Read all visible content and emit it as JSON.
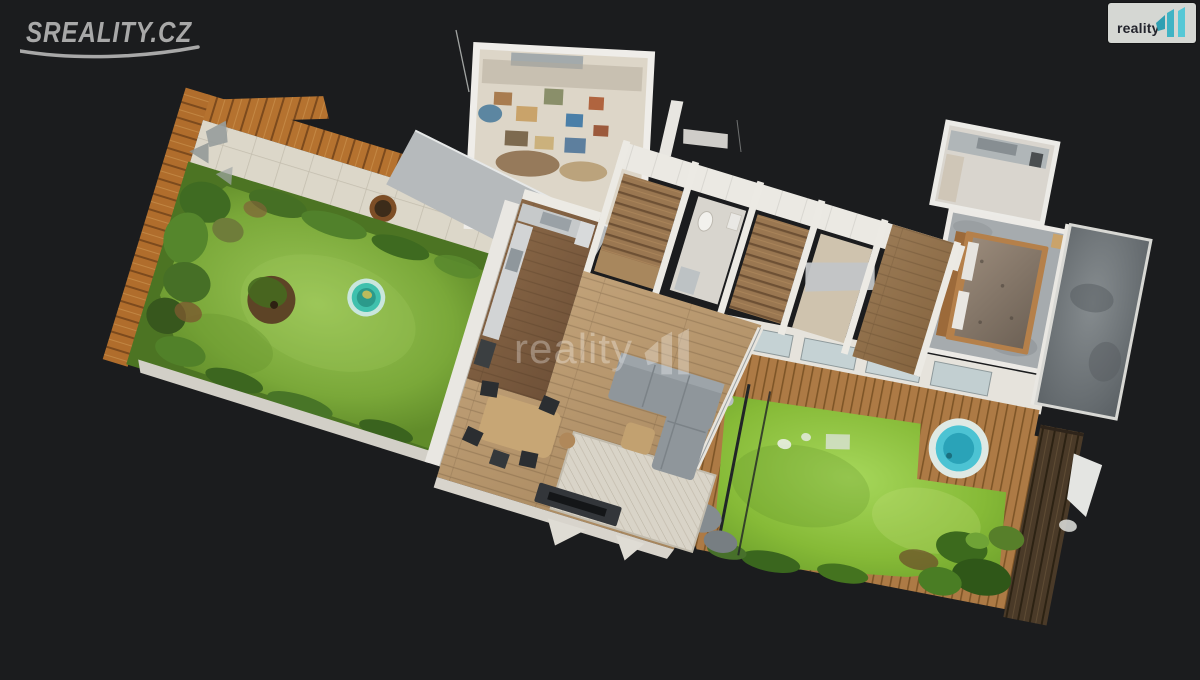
{
  "page": {
    "background": "#1b1c1e"
  },
  "header": {
    "sreality_logo": {
      "text": "SREALITY.CZ",
      "color": "#a8a8a8"
    },
    "reality11_badge": {
      "text": "reality",
      "background": "#d5d7d3",
      "text_color": "#23242c",
      "teal_dark": "#2f9fb2",
      "teal_mid": "#3fb3c4",
      "teal_light": "#55c8d6"
    }
  },
  "watermark": {
    "text": "reality",
    "color": "#ffffff",
    "opacity": 0.3
  },
  "scene": {
    "type": "3d-dollhouse-scan",
    "subject": "single-storey house with two gardens, terrace, hot tub and kiddie pool",
    "colors": {
      "lawn_left": "#7aa839",
      "lawn_right": "#86ba37",
      "fence_orange": "#b5722f",
      "fence_dark": "#4a3a28",
      "patio_tile": "#dcd7c9",
      "wood_floor": "#b5956e",
      "deck": "#ad7a45",
      "wall": "#eceae4",
      "pool": "#3fc0ad",
      "hot_tub": "#4cc3d3",
      "sofa": "#8f969b",
      "dining_table": "#c7a675",
      "rug": "#d9d4c8",
      "bed_frame": "#b5804a",
      "concrete": "#797f82"
    }
  }
}
